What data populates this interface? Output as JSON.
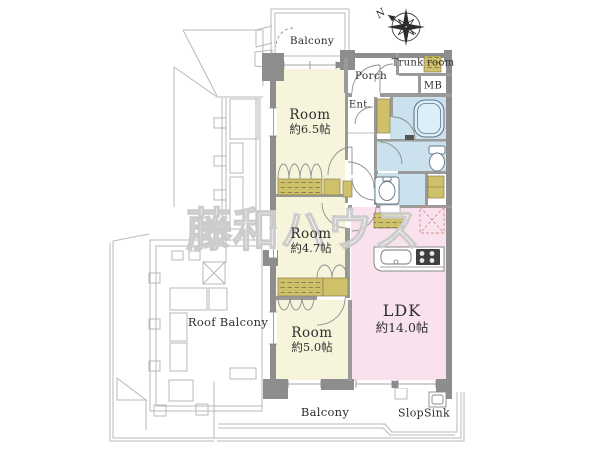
{
  "watermark": "藤和ハウス",
  "compass": {
    "north_label": "N"
  },
  "areas": {
    "balcony_top": "Balcony",
    "porch": "Porch",
    "trunk_room": "Trunk room",
    "meter_box": "MB",
    "entrance": "Ent.",
    "roof_balcony": "Roof Balcony",
    "balcony_bottom": "Balcony",
    "slop_sink": "SlopSink"
  },
  "rooms": [
    {
      "name": "Room",
      "size": "約6.5帖"
    },
    {
      "name": "Room",
      "size": "約4.7帖"
    },
    {
      "name": "Room",
      "size": "約5.0帖"
    },
    {
      "name": "LDK",
      "size": "約14.0帖"
    }
  ],
  "colors": {
    "room_fill": "#f6f5dc",
    "closet_fill": "#cfc06a",
    "water_fill": "#cbe2ee",
    "ldk_fill": "#f9e2ee",
    "wall": "#8d8d8d",
    "wall_light": "#9a9a9a",
    "outline": "#b8b8b8",
    "fixture_stroke": "#607585",
    "text": "#2e2e2e",
    "watermark_stroke": "#cccccc"
  }
}
